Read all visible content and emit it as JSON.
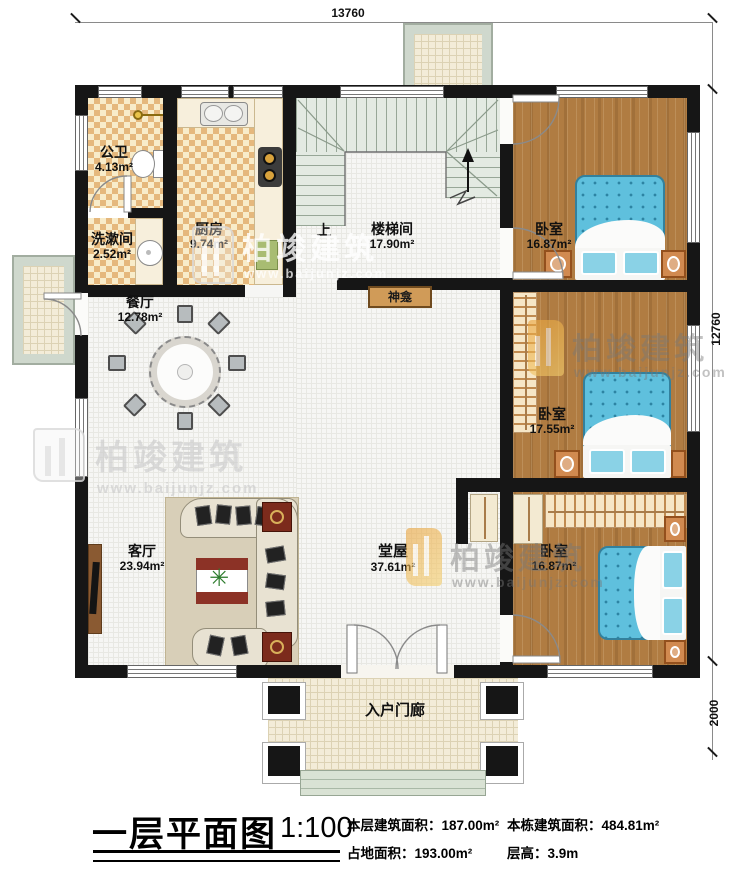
{
  "plan": {
    "dims": {
      "width_mm": "13760",
      "height_mm": "12760",
      "porch_mm": "2000"
    },
    "rooms": {
      "gongwei": {
        "label": "公卫",
        "area": "4.13m²"
      },
      "xishujian": {
        "label": "洗漱间",
        "area": "2.52m²"
      },
      "chufang": {
        "label": "厨房",
        "area": "9.74m²"
      },
      "loutijian": {
        "label": "楼梯间",
        "area": "17.90m²"
      },
      "up": "上",
      "woshi1": {
        "label": "卧室",
        "area": "16.87m²"
      },
      "canting": {
        "label": "餐厅",
        "area": "12.78m²"
      },
      "shenkan": {
        "label": "神龛"
      },
      "woshi2": {
        "label": "卧室",
        "area": "17.55m²"
      },
      "keting": {
        "label": "客厅",
        "area": "23.94m²"
      },
      "tangwu": {
        "label": "堂屋",
        "area": "37.61m²"
      },
      "woshi3": {
        "label": "卧室",
        "area": "16.87m²"
      },
      "menlang": {
        "label": "入户门廊"
      }
    },
    "title_block": {
      "title": "一层平面图",
      "scale": "1:100",
      "stats": {
        "floor": {
          "label": "本层建筑面积：",
          "value": "187.00m²"
        },
        "building": {
          "label": "本栋建筑面积：",
          "value": "484.81m²"
        },
        "land": {
          "label": "占地面积：",
          "value": "193.00m²"
        },
        "height": {
          "label": "层高：",
          "value": "3.9m"
        }
      }
    },
    "watermark": {
      "brand": "柏竣建筑",
      "url": "www.baijunjz.com"
    }
  }
}
